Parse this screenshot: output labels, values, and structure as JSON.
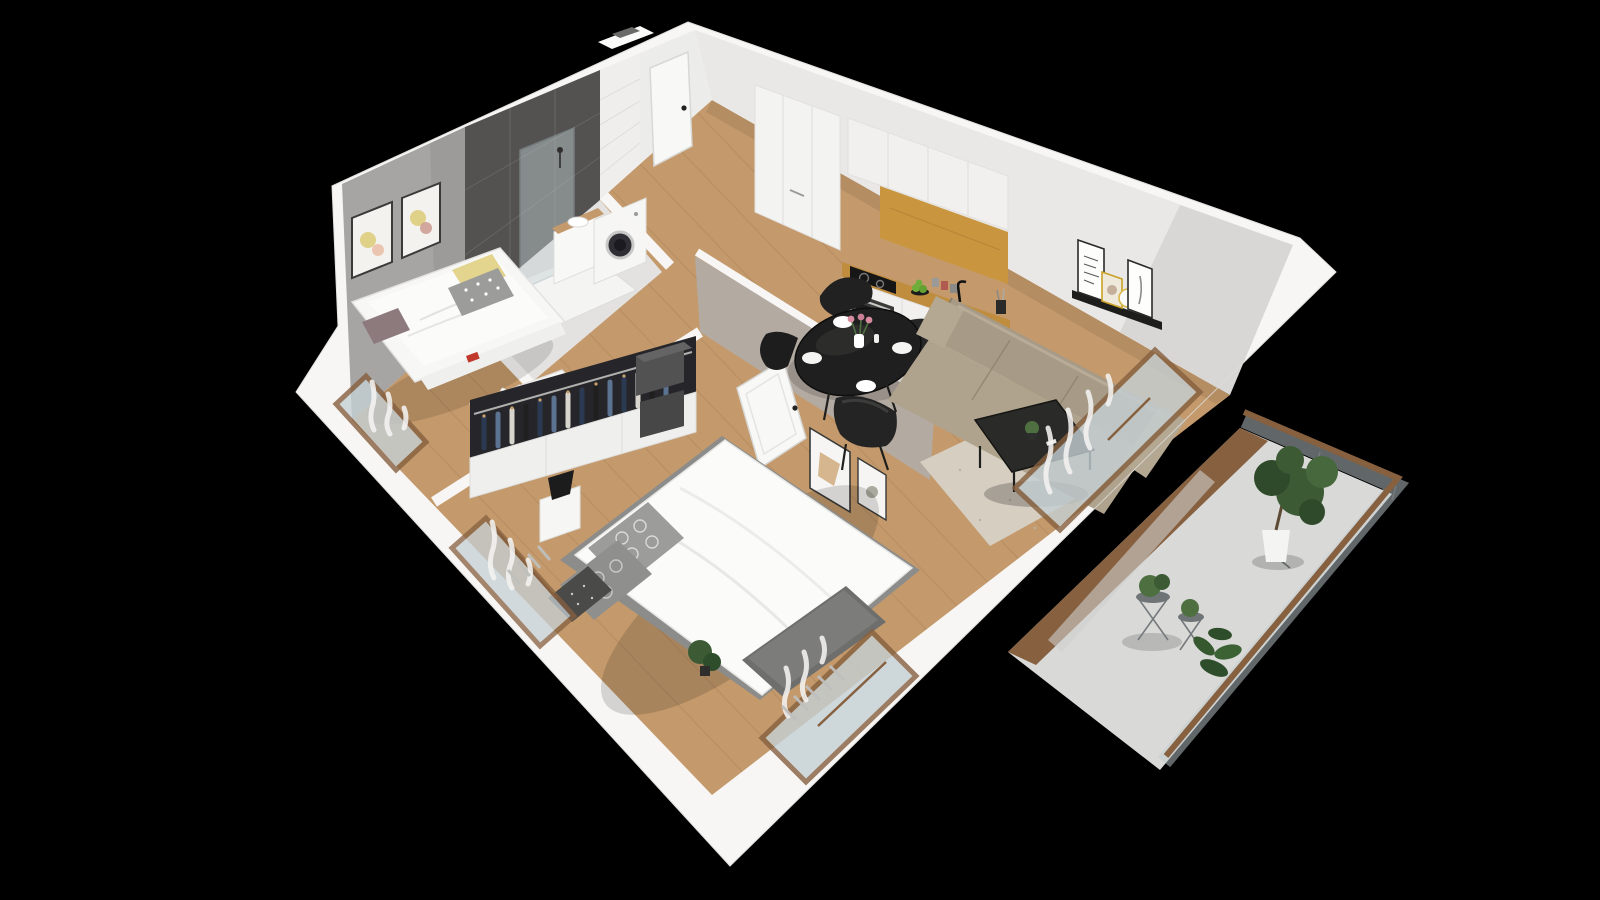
{
  "meta": {
    "content_type": "3d-apartment-floorplan-render",
    "view": "isometric-cutaway",
    "visible_text": "none",
    "background": "#000000"
  },
  "palette": {
    "bg": "#000000",
    "wall_white": "#f7f6f4",
    "wall_trim": "#e9e8e6",
    "floor_wood": "#c49a6c",
    "accent_wall_gray": "#a6a5a3",
    "bathroom_tile": "#535251",
    "subway_white": "#efeeec",
    "hall_wall": "#ececea",
    "door_white": "#f8f8f6",
    "wardrobe_front": "#f3f3f1",
    "cabinet_white": "#f1f0ee",
    "kitchen_oak": "#c9963f",
    "counter_oak": "#c08d3e",
    "appliance_dark": "#3a3a38",
    "sink_black": "#161616",
    "living_wall": "#e9e8e6",
    "ledge_black": "#1d1d1b",
    "sofa_taupe": "#a79a86",
    "rug_cream": "#d5cec1",
    "coffee_table_black": "#2a2a28",
    "dining_table_black": "#1f1f1f",
    "chair_black": "#212121",
    "wall_taupe": "#b3aaa2",
    "bed_white": "#fbfbf9",
    "pillow_gray": "#9c9c9a",
    "pillow_yellow": "#e3d48e",
    "closet_dark": "#26262a",
    "clothes_navy": "#2b3a52",
    "clothes_denim": "#5b7291",
    "storage_box_gray": "#525252",
    "wood_frame": "#86603f",
    "glass_pane": "#c5d0d4",
    "curtain_white": "#f4f3f1",
    "balcony_floor": "#d9d9d7",
    "plant_green": "#3c5a34",
    "plant_light_green": "#4e7040",
    "pot_white": "#f4f4f2",
    "washer_door": "#2e2e34",
    "apple_green": "#6fae3a",
    "tulip_pink": "#d98ca0",
    "book_red": "#c0392b"
  },
  "scene": {
    "rooms": [
      {
        "name": "small-bedroom",
        "position": "top-left",
        "items": [
          "gray-accent-wall",
          "two-framed-prints",
          "daybed-white",
          "yellow-pillow",
          "polka-dot-pillow",
          "mauve-cushion",
          "under-bed-storage",
          "kids-desk",
          "bunny-ear-chair",
          "desk-lamp",
          "window-with-curtain"
        ]
      },
      {
        "name": "bathroom",
        "position": "top-center",
        "items": [
          "dark-gray-wall-tiles",
          "glass-shower",
          "shower-tray",
          "vanity-sink",
          "washing-machine",
          "white-subway-tile-column"
        ]
      },
      {
        "name": "entry-hall",
        "position": "top",
        "items": [
          "front-door",
          "tall-white-wardrobe"
        ]
      },
      {
        "name": "kitchen",
        "position": "upper-right",
        "items": [
          "white-upper-cabinets",
          "oak-accent-panel",
          "oak-countertop",
          "induction-cooktop",
          "built-in-oven",
          "black-sink",
          "black-faucet",
          "apples-on-plate",
          "spice-jars",
          "utensil-cup"
        ]
      },
      {
        "name": "dining-area",
        "position": "center",
        "items": [
          "round-black-table",
          "four-black-chairs",
          "white-plates",
          "vase-with-tulips"
        ]
      },
      {
        "name": "living-room",
        "position": "right",
        "items": [
          "taupe-leather-sofa",
          "picture-ledge-shelf",
          "framed-prints",
          "round-gold-mirror",
          "black-coffee-table",
          "small-plant",
          "cream-rug",
          "sliding-glass-door",
          "sheer-curtains"
        ]
      },
      {
        "name": "main-bedroom",
        "position": "bottom-center",
        "items": [
          "double-bed-white-duvet",
          "patterned-pillows",
          "open-wardrobe-hanging-clothes",
          "white-shelving",
          "gray-storage-boxes",
          "nightstand",
          "black-table-lamp",
          "taupe-wall-with-frames",
          "open-white-door",
          "bench",
          "plant",
          "two-windows-with-curtains",
          "radiators"
        ]
      },
      {
        "name": "balcony",
        "position": "lower-right",
        "items": [
          "glass-railing",
          "wood-handrail",
          "wood-deck-strip",
          "potted-ficus-white-pot",
          "plant-stands",
          "fiddle-leaf-plant"
        ]
      }
    ],
    "floors": {
      "living_areas": "oak-plank",
      "bathroom": "light-gray-tile",
      "balcony": "light-concrete"
    }
  }
}
